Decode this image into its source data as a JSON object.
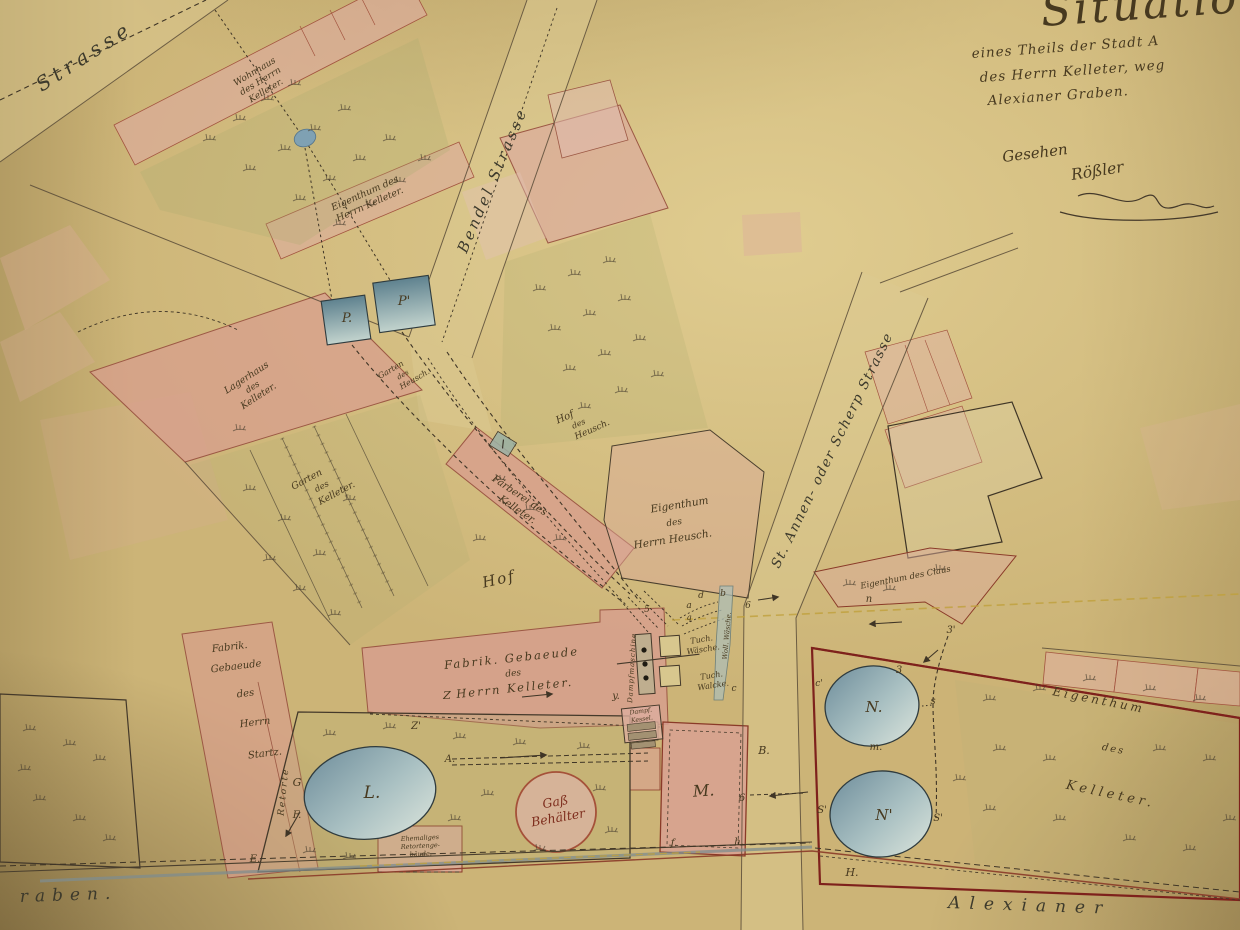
{
  "title_block": {
    "title_fragment": "Situation",
    "line1": "eines Theils der Stadt A",
    "line2": "des Herrn Kelleter, weg",
    "line3": "Alexianer Graben.",
    "seen_label": "Gesehen",
    "seen_signature": "Rößler"
  },
  "streets": {
    "strasse": "Strasse",
    "bendel_strasse": "Bendel Strasse",
    "scherp_strasse": "St. Annen- oder Scherp Strasse",
    "alexianer_fragment_left": "raben.",
    "alexianer_fragment_right": "Alexianer"
  },
  "labels": {
    "wohnhaus": [
      "Wohnhaus",
      "des Herrn",
      "Kelleter."
    ],
    "eigenthum_kelleter_nw": [
      "Eigenthum des",
      "Herrn Kelleter."
    ],
    "lagerhaus": [
      "Lagerhaus",
      "des",
      "Kelleter."
    ],
    "garten_kelleter": [
      "Garten",
      "des",
      "Kelleter."
    ],
    "garten_heusch": [
      "Garten",
      "des",
      "Heusch."
    ],
    "hof_heusch": [
      "Hof",
      "des",
      "Heusch."
    ],
    "faerberei": [
      "Färberei des",
      "Kelleter."
    ],
    "eigenthum_heusch": [
      "Eigenthum",
      "des",
      "Herrn Heusch."
    ],
    "eigenthum_claus": "Eigenthum des Claus",
    "hof": "Hof",
    "fabrik_kelleter": [
      "Fabrik. Gebaeude",
      "des",
      "Herrn Kelleter."
    ],
    "fabrik_startz": [
      "Fabrik.",
      "Gebaeude",
      "des",
      "Herrn",
      "Startz."
    ],
    "retorte": "Retorte",
    "ehemaliges_retortengebaeude": [
      "Ehemaliges",
      "Retortenge-",
      "bäude."
    ],
    "gas_behaelter": [
      "Gaß",
      "Behälter"
    ],
    "eigenthum_kelleter_ost": [
      "Eigenthum",
      "des",
      "Kelleter."
    ],
    "dampfmaschine": "Dampfmaschine",
    "tuch_waesche": [
      "Tuch.",
      "Wäsche."
    ],
    "tuch_walcke": [
      "Tuch.",
      "Walcke."
    ],
    "dampf_kessel": [
      "Dampf.",
      "Kessel."
    ],
    "woll_waesche": "Woll. Wäsche."
  },
  "markers": {
    "p": "P.",
    "p_prime": "P'",
    "l": "L.",
    "m": "M.",
    "n": "N.",
    "n_prime": "N'",
    "a": "A.",
    "b": "B.",
    "g": "G",
    "z": "Z",
    "z_prime": "Z'",
    "y": "y.",
    "e": "E.",
    "f": "F.",
    "f_small": "f.",
    "h_small": "h.",
    "h": "H.",
    "m_small": "m.",
    "n_small": "n",
    "s_small": "s",
    "s_prime": "S'",
    "c_prime": "c'",
    "three": "3",
    "three_prime": "3'",
    "six": "6",
    "five": "5",
    "d_small": "d",
    "b_small": "b",
    "a_small": "a",
    "c_small": "c",
    "q_small": "q"
  },
  "colors": {
    "paper": "#ccb477",
    "parcel_pink": "#d89c8e",
    "parcel_red_outline": "#7e211c",
    "ink": "#44392a",
    "blue_structure": "#74929f",
    "gas_red": "#a03226",
    "survey_yellow": "#bfa03c",
    "water_gray": "#7f8c8d"
  }
}
